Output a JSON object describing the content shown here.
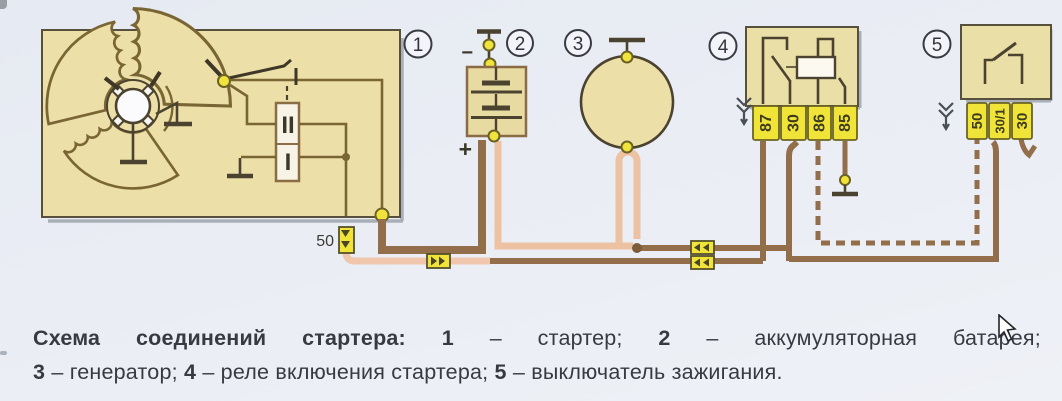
{
  "callouts": {
    "c1": "1",
    "c2": "2",
    "c3": "3",
    "c4": "4",
    "c5": "5"
  },
  "starter": {
    "terminal_label": "50",
    "solenoid_winding_top": "II",
    "solenoid_winding_bottom": "I"
  },
  "battery": {
    "plus_label": "+",
    "minus_label": "−"
  },
  "relay": {
    "terminals": [
      "87",
      "30",
      "86",
      "85"
    ]
  },
  "ignition_switch": {
    "terminals": [
      "50",
      "30/1",
      "30"
    ]
  },
  "caption": {
    "title": "Схема соединений стартера:",
    "items": [
      {
        "num": "1",
        "text": "– стартер;"
      },
      {
        "num": "2",
        "text": "– аккумуляторная батарея;"
      },
      {
        "num": "3",
        "text": "– генератор;"
      },
      {
        "num": "4",
        "text": "– реле включения стартера;"
      },
      {
        "num": "5",
        "text": "– выключатель зажигания."
      }
    ]
  },
  "colors": {
    "panel_beige": "#ece0a8",
    "terminal_yellow": "#f0e438",
    "wire_brown": "#926e4b",
    "wire_salmon": "#edc2a2",
    "wire_pink": "#f0c6ac",
    "schematic_dark": "#4b4330",
    "schematic_olive": "#7a6535",
    "text_dark": "#383a42"
  }
}
